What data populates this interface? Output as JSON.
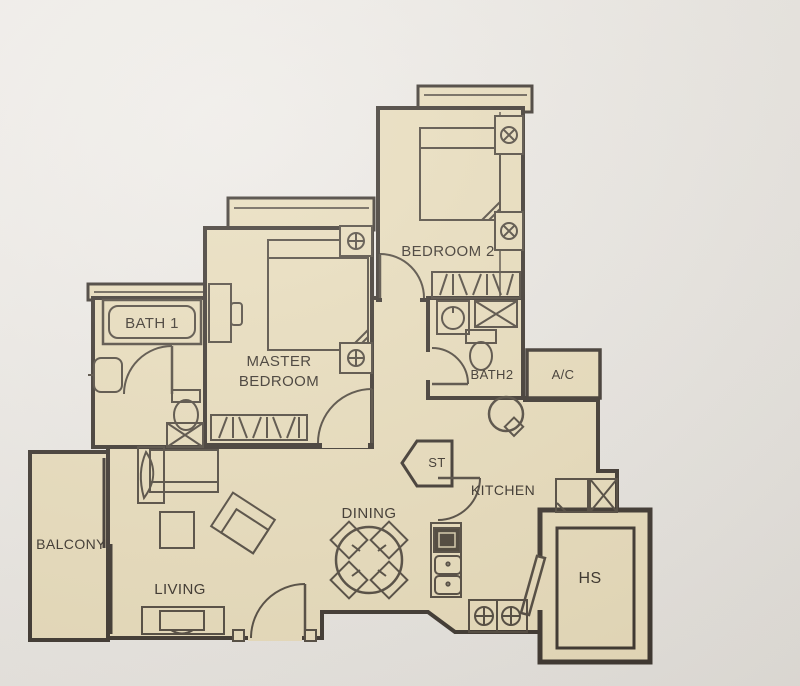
{
  "plan": {
    "kind": "apartment-floor-plan",
    "rooms": {
      "balcony": {
        "label": "BALCONY"
      },
      "living": {
        "label": "LIVING"
      },
      "dining": {
        "label": "DINING"
      },
      "kitchen": {
        "label": "KITCHEN"
      },
      "master_bedroom": {
        "label": "MASTER BEDROOM"
      },
      "bedroom2": {
        "label": "BEDROOM 2"
      },
      "bath1": {
        "label": "BATH 1"
      },
      "bath2": {
        "label": "BATH2"
      },
      "ac_ledge": {
        "label": "A/C"
      },
      "store": {
        "label": "ST"
      },
      "household_shelter": {
        "label": "HS"
      }
    },
    "symbols": {
      "window_mark": "circle-with-cross window symbol",
      "shaft": "box with X (duct/shaft)",
      "service_point": "circle with cross (gas/water point)"
    },
    "colors": {
      "floor": "#e8dcba",
      "wall": "#38312a",
      "furniture_line": "#4d453a",
      "paper": "#eae7e2"
    }
  }
}
